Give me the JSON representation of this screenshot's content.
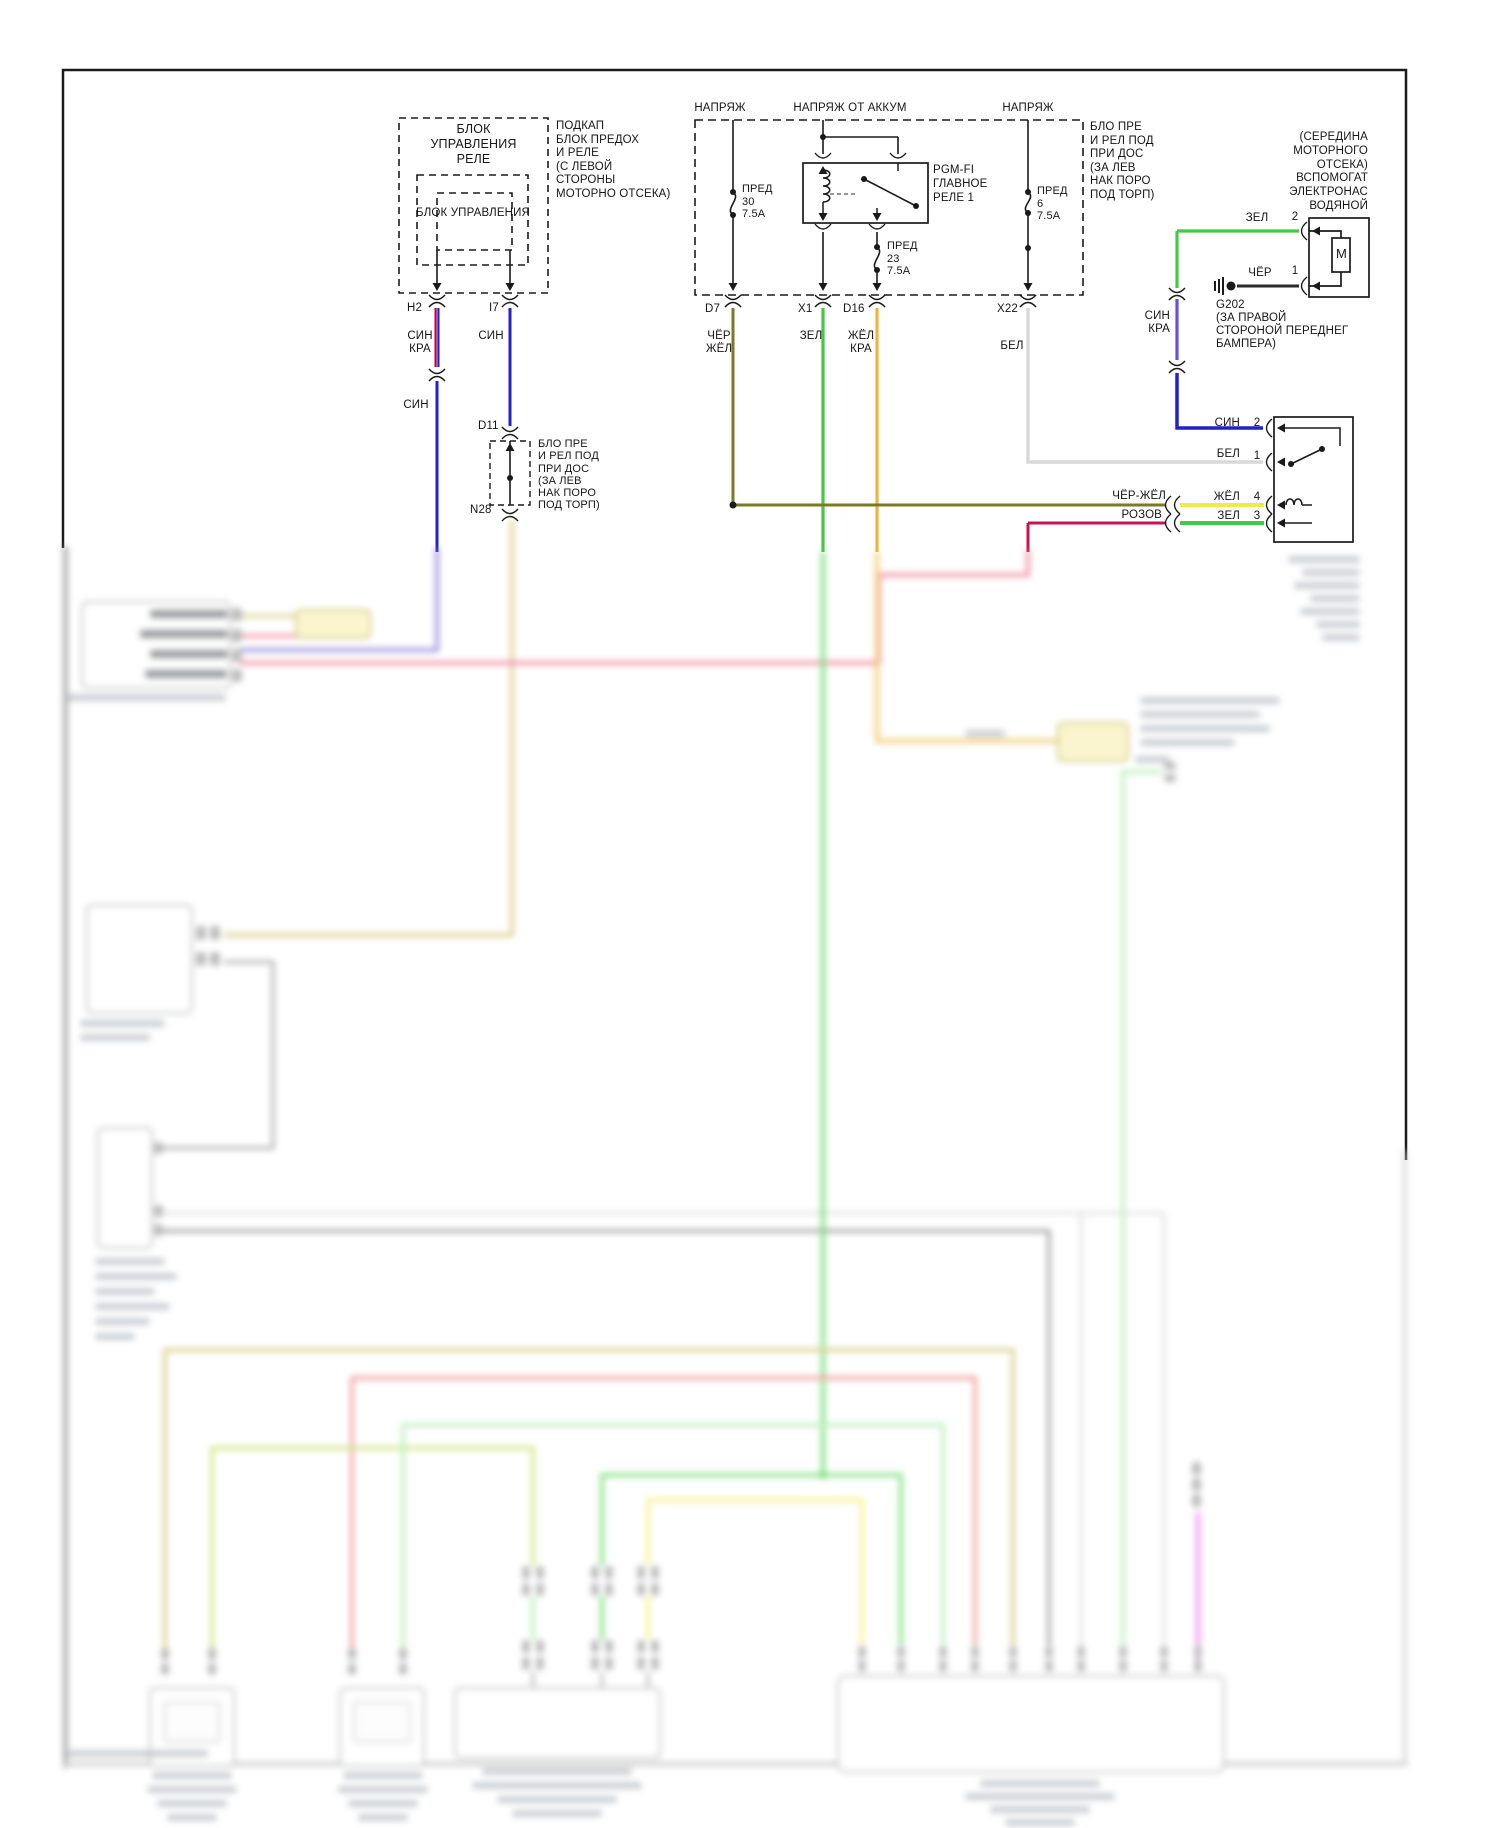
{
  "diagram_type": "vehicle wiring diagram (auxiliary electric water pump circuit, Russian)",
  "relay_unit": {
    "title": "БЛОК\nУПРАВЛЕНИЯ\nРЕЛЕ",
    "inner": "БЛОК УПРАВЛЕНИЯ",
    "note": "ПОДКАП\nБЛОК ПРЕДОХ\nИ РЕЛЕ\n(С ЛЕВОЙ\nСТОРОНЫ\nМОТОРНО ОТСЕКА)",
    "pin_h2": "H2",
    "pin_i7": "I7"
  },
  "fuse_box": {
    "voltage_left": "НАПРЯЖ",
    "voltage_mid": "НАПРЯЖ ОТ АККУМ",
    "voltage_right": "НАПРЯЖ",
    "fuse30": "ПРЕД\n30\n7.5A",
    "fuse23": "ПРЕД\n23\n7.5A",
    "fuse6": "ПРЕД\n6\n7.5A",
    "relay": "PGM-FI\nГЛАВНОЕ\nРЕЛЕ 1",
    "note": "БЛО ПРЕ\nИ РЕЛ ПОД\nПРИ ДОС\n(ЗА ЛЕВ\nНАК ПОРО\nПОД ТОРП)",
    "pin_d7": "D7",
    "pin_x1": "X1",
    "pin_d16": "D16",
    "pin_x22": "X22"
  },
  "d11_box": {
    "top": "D11",
    "bottom": "N28",
    "note": "БЛО ПРЕ\nИ РЕЛ ПОД\nПРИ ДОС\n(ЗА ЛЕВ\nНАК ПОРО\nПОД ТОРП)"
  },
  "water_pump": {
    "note": "(СЕРЕДИНА\nМОТОРНОГО\nОТСЕКА)\nВСПОМОГАТ\nЭЛЕКТРОНАС\nВОДЯНОЙ",
    "motor": "M",
    "pin2": "2",
    "pin1": "1"
  },
  "ground": {
    "id": "G202",
    "note": "(ЗА ПРАВОЙ\nСТОРОНОЙ ПЕРЕДНЕГ\nБАМПЕРА)"
  },
  "pump_relay": {
    "pin2": "2",
    "pin1": "1",
    "pin4": "4",
    "pin3": "3"
  },
  "wires": {
    "sin_kra_h2": "СИН\nКРА",
    "sin_h2": "СИН",
    "sin_i7": "СИН",
    "chyor_zhyol_d7": "ЧЁР\nЖЁЛ",
    "zel_x1": "ЗЕЛ",
    "zhyol_kra_d16": "ЖЁЛ\nКРА",
    "bel_x22": "БЕЛ",
    "zel_pump": "ЗЕЛ",
    "chyor_ground": "ЧЁР",
    "sin_kra_right": "СИН\nКРА",
    "sin_pin2": "СИН",
    "bel_pin1": "БЕЛ",
    "chyor_zhyol_row": "ЧЁР-ЖЁЛ",
    "zhyol_pin4": "ЖЁЛ",
    "rozov_row": "РОЗОВ",
    "zel_pin3": "ЗЕЛ"
  },
  "colors": {
    "sin_blue": "#2222c8",
    "kra_red": "#c00040",
    "zel_green": "#44c944",
    "zhyol_yellow": "#f2e84a",
    "chyor_zhyol_olive": "#7a7a28",
    "zhyol_kra_orange": "#efb33e",
    "bel_white": "#d9d9d9",
    "chyor_black": "#2a2a2a",
    "sin_kra_violet": "#6a4fd8",
    "rozov_pink": "#ce1050",
    "frame_black": "#1a1a1a"
  }
}
